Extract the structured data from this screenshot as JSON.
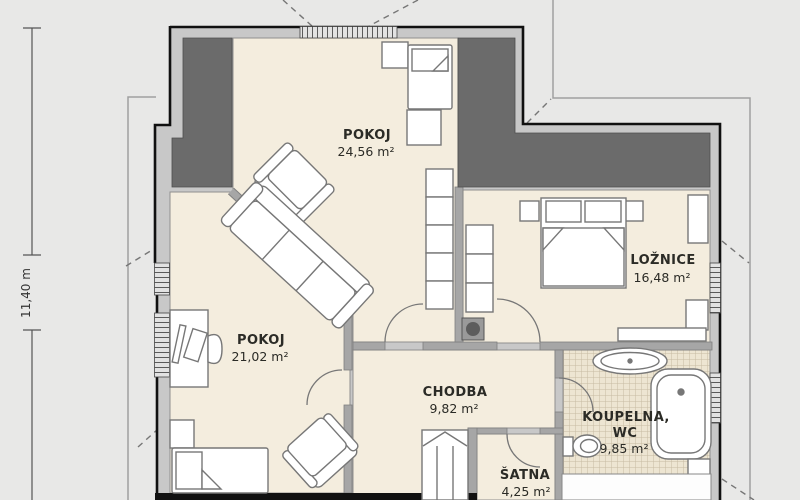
{
  "plan": {
    "dimension_label": "11,40 m",
    "rooms": [
      {
        "name": "POKOJ",
        "area": "24,56 m²"
      },
      {
        "name": "POKOJ",
        "area": "21,02 m²"
      },
      {
        "name": "LOŽNICE",
        "area": "16,48 m²"
      },
      {
        "name": "CHODBA",
        "area": "9,82 m²"
      },
      {
        "name": "ŠATNA",
        "area": "4,25 m²"
      },
      {
        "name": "KOUPELNA,",
        "name_line2": "WC",
        "area": "9,85 m²"
      }
    ],
    "colors": {
      "background": "#e8e8e7",
      "room_fill": "#f4edde",
      "outer_band": "#c8c8c8",
      "wall_dark": "#6b6b6b",
      "wall_inner": "#a6a6a6",
      "outline": "#111111",
      "tile_fill": "#ede5d2",
      "tile_line": "#c6baa3"
    }
  }
}
